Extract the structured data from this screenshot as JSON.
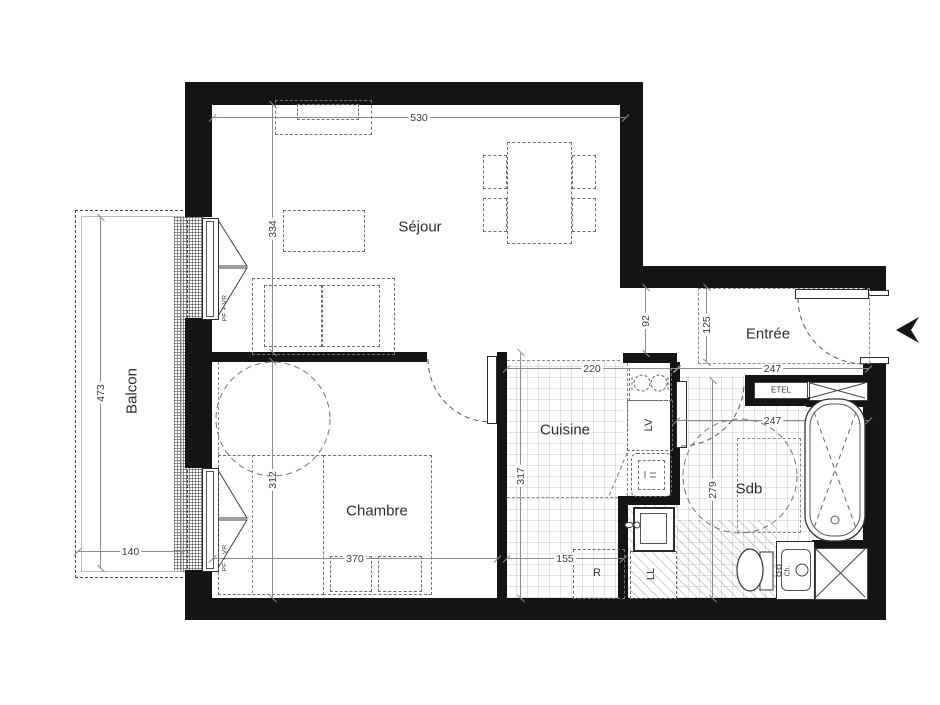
{
  "plan": {
    "rooms": {
      "sejour": {
        "label": "Séjour",
        "width": "530",
        "depth": "334"
      },
      "chambre": {
        "label": "Chambre",
        "width": "370",
        "depth": "312"
      },
      "cuisine": {
        "label": "Cuisine",
        "width": "220",
        "depth": "317",
        "lower_width": "155"
      },
      "entree": {
        "label": "Entrée",
        "width": "247",
        "hall_depth": "125",
        "passage_width": "92"
      },
      "sdb": {
        "label": "Sdb",
        "width": "247",
        "depth": "279"
      },
      "balcon": {
        "label": "Balcon",
        "width": "140",
        "length": "473"
      }
    },
    "fixtures": {
      "dishwasher": "LV",
      "fridge": "R",
      "washing_machine": "LL",
      "electrical_niche": "ETEL",
      "water_heater": "Ch.",
      "sejour_window": "PF + VR",
      "chambre_window": "PF + VR"
    }
  }
}
